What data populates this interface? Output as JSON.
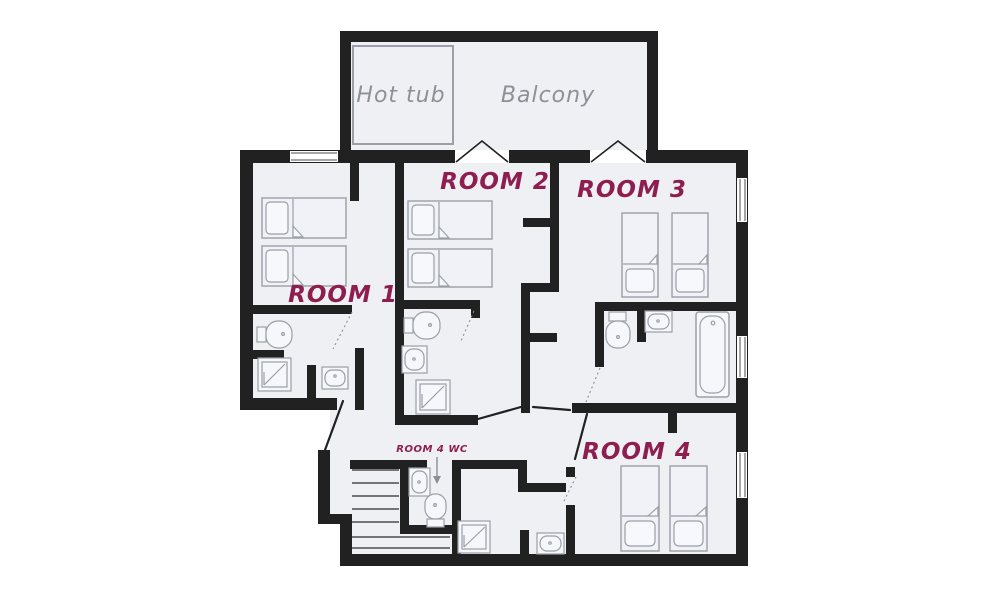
{
  "labels": {
    "hot_tub": "Hot tub",
    "balcony": "Balcony",
    "room1": "ROOM 1",
    "room2": "ROOM 2",
    "room3": "ROOM 3",
    "room4": "ROOM 4",
    "room4_wc": "ROOM 4 WC"
  },
  "colors": {
    "background": "#ffffff",
    "wall": "#212121",
    "floor": "#eef0f4",
    "fixture_outline": "#9aa0a6",
    "fixture_fill": "#f6f7fa",
    "bed_fill": "#f1f2f7",
    "pillow_fill": "#f7f8fc",
    "label_gray": "#8d9196",
    "label_maroon": "#8e1e4f"
  }
}
